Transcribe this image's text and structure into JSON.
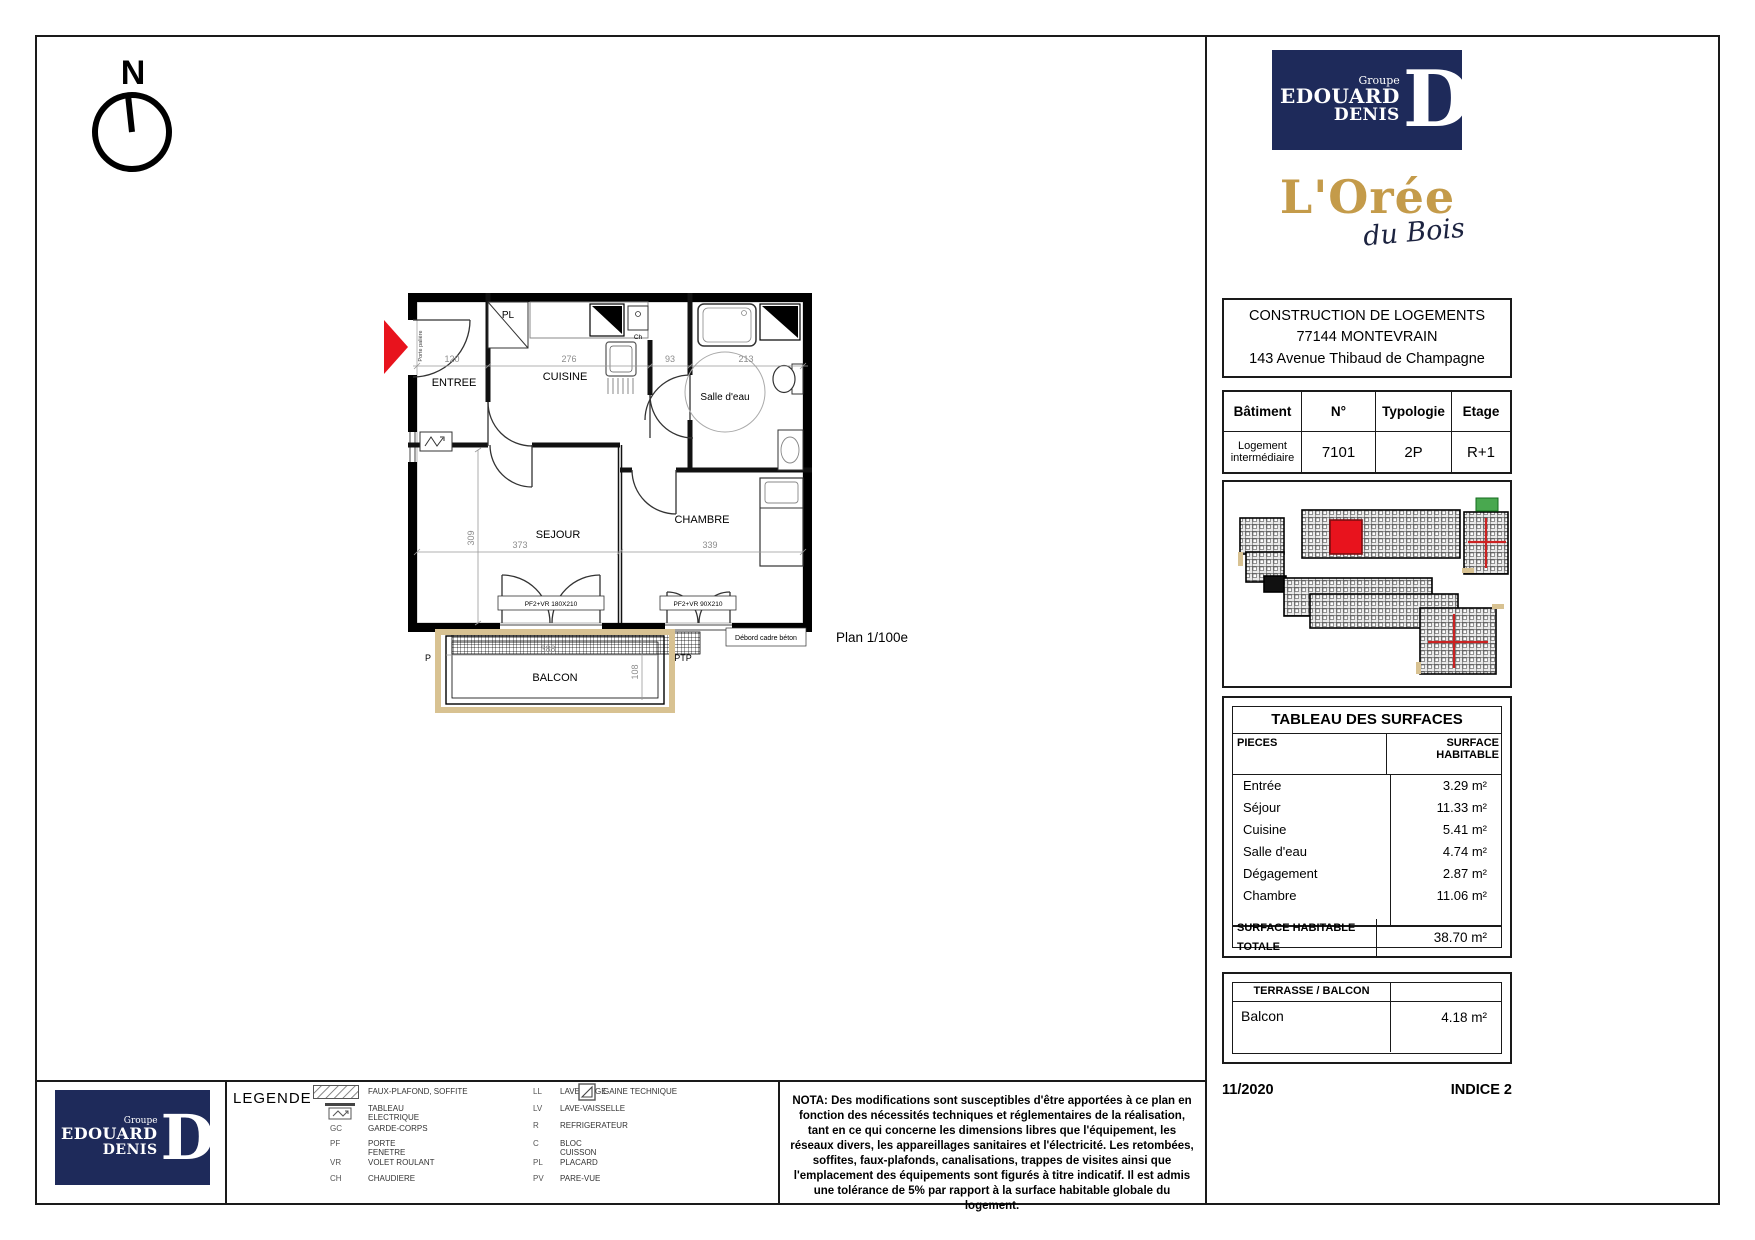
{
  "colors": {
    "navy": "#1e2a5a",
    "gold": "#c49b4a",
    "red": "#e8131d",
    "tan": "#d8c292"
  },
  "compass": {
    "north": "N"
  },
  "plan": {
    "scale_label": "Plan 1/100e",
    "rooms": {
      "entree": "ENTREE",
      "cuisine": "CUISINE",
      "salle_deau": "Salle d'eau",
      "sejour": "SEJOUR",
      "chambre": "CHAMBRE",
      "balcon": "BALCON",
      "placard": "PL",
      "chaudiere": "Ch"
    },
    "dims": {
      "entree_w": "120",
      "cuisine_w": "276",
      "degagement_w": "93",
      "salle_deau_w": "213",
      "sejour_h": "309",
      "sejour_w": "373",
      "chambre_w": "339",
      "balcon_w": "388",
      "balcon_d": "108"
    },
    "annotations": {
      "porte_paliere": "Porte palière",
      "sejour_window": "PF2+VR 180X210",
      "chambre_window": "PF2+VR 90X210",
      "debord": "Débord cadre béton",
      "p": "P",
      "ptp": "PTP"
    }
  },
  "brand": {
    "groupe": "Groupe",
    "name1": "EDOUARD",
    "name2": "DENIS",
    "monogram": "D",
    "residence1": "L'Orée",
    "residence2": "du Bois"
  },
  "project": {
    "line1": "CONSTRUCTION DE LOGEMENTS",
    "line2": "77144 MONTEVRAIN",
    "line3": "143 Avenue Thibaud de Champagne"
  },
  "unit": {
    "headers": [
      "Bâtiment",
      "N°",
      "Typologie",
      "Etage"
    ],
    "batiment": "Logement intermédiaire",
    "numero": "7101",
    "typologie": "2P",
    "etage": "R+1"
  },
  "surfaces": {
    "title": "TABLEAU DES SURFACES",
    "col_pieces": "PIECES",
    "col_surface": "SURFACE HABITABLE",
    "rows": [
      {
        "name": "Entrée",
        "area": "3.29 m²"
      },
      {
        "name": "Séjour",
        "area": "11.33 m²"
      },
      {
        "name": "Cuisine",
        "area": "5.41 m²"
      },
      {
        "name": "Salle d'eau",
        "area": "4.74 m²"
      },
      {
        "name": "Dégagement",
        "area": "2.87 m²"
      },
      {
        "name": "Chambre",
        "area": "11.06 m²"
      }
    ],
    "total_label": "SURFACE HABITABLE TOTALE",
    "total_area": "38.70 m²"
  },
  "terrasse": {
    "header": "TERRASSE / BALCON",
    "name": "Balcon",
    "area": "4.18 m²"
  },
  "footer_meta": {
    "date": "11/2020",
    "indice": "INDICE 2"
  },
  "legend": {
    "title": "LEGENDE",
    "col1": [
      {
        "label": "FAUX-PLAFOND, SOFFITE"
      },
      {
        "label": "TABLEAU ELECTRIQUE"
      },
      {
        "abbr": "GC",
        "label": "GARDE-CORPS"
      },
      {
        "abbr": "PF",
        "label": "PORTE FENETRE"
      },
      {
        "abbr": "VR",
        "label": "VOLET ROULANT"
      },
      {
        "abbr": "CH",
        "label": "CHAUDIERE"
      }
    ],
    "col2": [
      {
        "abbr": "LL",
        "label": "LAVE-LINGE"
      },
      {
        "abbr": "LV",
        "label": "LAVE-VAISSELLE"
      },
      {
        "abbr": "R",
        "label": "REFRIGERATEUR"
      },
      {
        "abbr": "C",
        "label": "BLOC CUISSON"
      },
      {
        "abbr": "PL",
        "label": "PLACARD"
      },
      {
        "abbr": "PV",
        "label": "PARE-VUE"
      }
    ],
    "gaine": "GAINE TECHNIQUE"
  },
  "nota": "NOTA: Des modifications sont susceptibles d'être apportées à ce plan en fonction des nécessités techniques et réglementaires de la réalisation, tant en ce qui concerne les dimensions libres que l'équipement, les réseaux divers, les appareillages sanitaires et l'électricité. Les retombées, soffites, faux-plafonds, canalisations, trappes de visites ainsi que l'emplacement des équipements sont figurés à titre indicatif. Il est admis une tolérance de 5% par rapport à la surface habitable globale du logement."
}
